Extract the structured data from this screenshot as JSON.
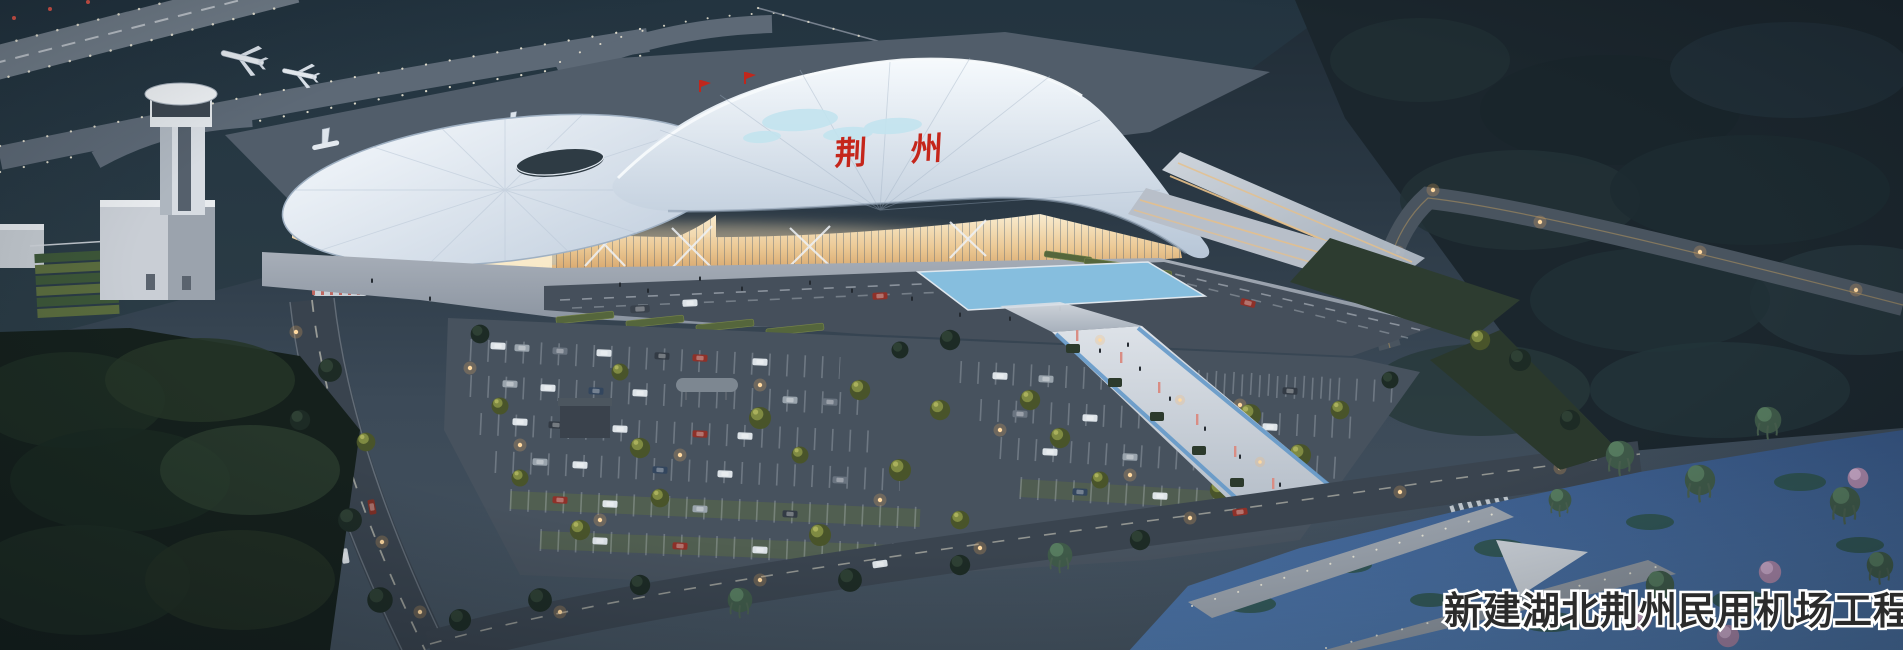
{
  "image": {
    "type": "architectural-rendering-dusk-aerial",
    "caption_text": "新建湖北荆州民用机场工程",
    "terminal_sign_text": "荆州",
    "landmarks": [
      "runway",
      "taxiways",
      "control-tower",
      "terminal-building",
      "apron-airplanes",
      "parking-lots",
      "landscaped-plaza",
      "reflecting-pool",
      "pedestrian-axis",
      "waterfront-park",
      "access-roads",
      "forest"
    ],
    "colors": {
      "dusk_sky_ground": "#2a3844",
      "airfield_grass": "#253641",
      "taxiway_gray": "#5d6976",
      "roof_white": "#e8eff6",
      "facade_glow_amber": "#e9c48c",
      "sign_red": "#c5261b",
      "asphalt": "#47525e",
      "water_blue": "#41649b",
      "tree_dark": "#1d2b25",
      "tree_lit_olive": "#7f8a42",
      "tree_pink": "#c3a0c0",
      "street_light_warm": "#ffd9a0",
      "caption_fill": "#2b2b2b",
      "caption_outline": "#ffffff"
    }
  }
}
